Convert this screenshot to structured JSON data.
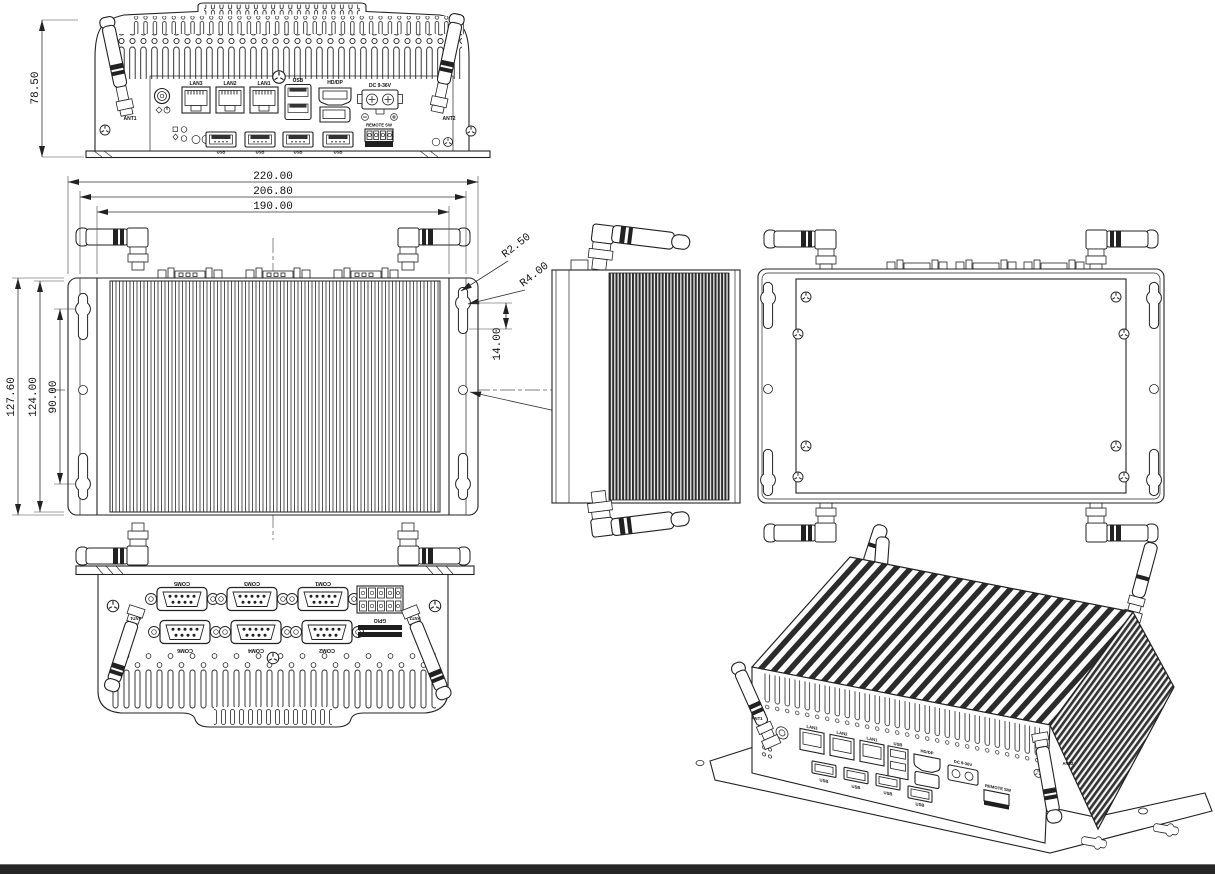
{
  "colors": {
    "line": "#222222",
    "fin_dark": "#2e2e2e",
    "bar": "#262626"
  },
  "front": {
    "dim_height": "78.50",
    "ant1": "ANT1",
    "ant2": "ANT2",
    "lan3": "LAN3",
    "lan2": "LAN2",
    "lan1": "LAN1",
    "usb_top": "USB",
    "hddp": "HD/DP",
    "dc": "DC 9-36V",
    "remote_sw": "REMOTE SW",
    "usb_b1": "USB",
    "usb_b2": "USB",
    "usb_b3": "USB",
    "usb_b4": "USB"
  },
  "top": {
    "d220": "220.00",
    "d206": "206.80",
    "d190": "190.00",
    "d127": "127.60",
    "d124": "124.00",
    "d90": "90.00",
    "r250": "R2.50",
    "r400": "R4.00",
    "d14": "14.00",
    "dia5": "Ø5.00"
  },
  "rear": {
    "com1": "COM1",
    "com2": "COM2",
    "com3": "COM3",
    "com4": "COM4",
    "com5": "COM5",
    "com6": "COM6",
    "gpio": "GPIO",
    "ant3": "ANT3",
    "ant4": "ANT4"
  },
  "iso": {
    "lan3": "LAN3",
    "lan2": "LAN2",
    "lan1": "LAN1",
    "usb": "USB",
    "hddp": "HD/DP",
    "dc": "DC 9-36V",
    "remote_sw": "REMOTE SW",
    "usb_b1": "USB",
    "usb_b2": "USB",
    "usb_b3": "USB",
    "usb_b4": "USB",
    "ant1": "ANT1",
    "ant2": "ANT2"
  }
}
